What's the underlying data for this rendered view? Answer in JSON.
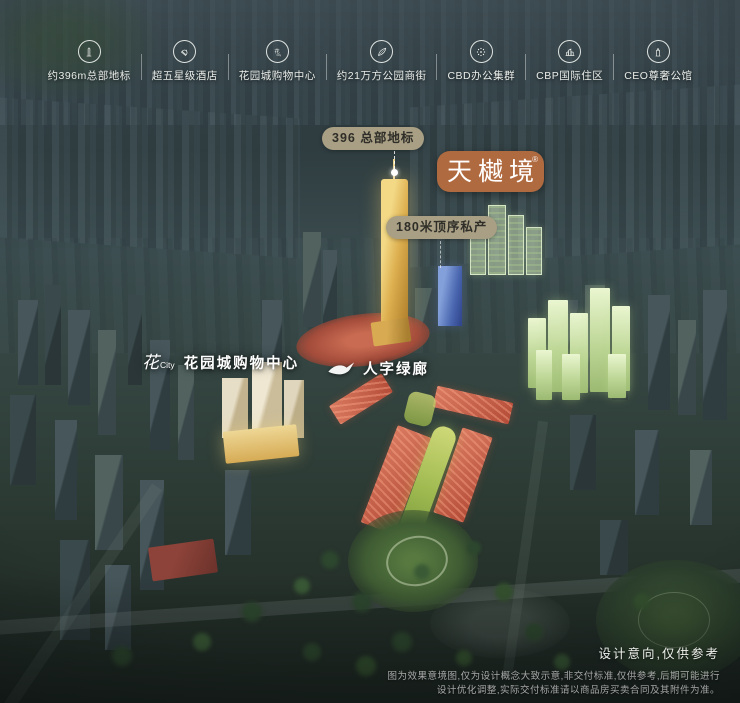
{
  "header": {
    "features": [
      {
        "label": "约396m总部地标",
        "icon": "landmark-tower-icon"
      },
      {
        "label": "超五星级酒店",
        "icon": "hotel-bell-icon"
      },
      {
        "label": "花园城购物中心",
        "icon": "flower-city-mall-icon"
      },
      {
        "label": "约21万方公园商街",
        "icon": "park-leaf-icon"
      },
      {
        "label": "CBD办公集群",
        "icon": "office-cluster-icon"
      },
      {
        "label": "CBP国际住区",
        "icon": "residence-buildings-icon"
      },
      {
        "label": "CEO尊奢公馆",
        "icon": "mansion-tower-icon"
      }
    ]
  },
  "callouts": {
    "landmark_pill": "396 总部地标",
    "brand_badge": "天樾境",
    "brand_reg_mark": "®",
    "residence_pill": "180米顶序私产",
    "mall_logo_hua": "花",
    "mall_logo_city": "City",
    "mall_label": "花园城购物中心",
    "green_corridor_label": "人字绿廊"
  },
  "disclaimer": {
    "title": "设计意向,仅供参考",
    "line1": "图为效果意境图,仅为设计概念大致示意,非交付标准,仅供参考,后期可能进行",
    "line2": "设计优化调整,实际交付标准请以商品房买卖合同及其附件为准。"
  },
  "colors": {
    "brand_badge_bg": "#b06a40",
    "label_pill_bg": "#a89f84",
    "gold_tower": "#e8c25f",
    "green_residence": "#cfe6ab",
    "blue_tower": "#5a79c0",
    "red_street": "#c96a52"
  }
}
